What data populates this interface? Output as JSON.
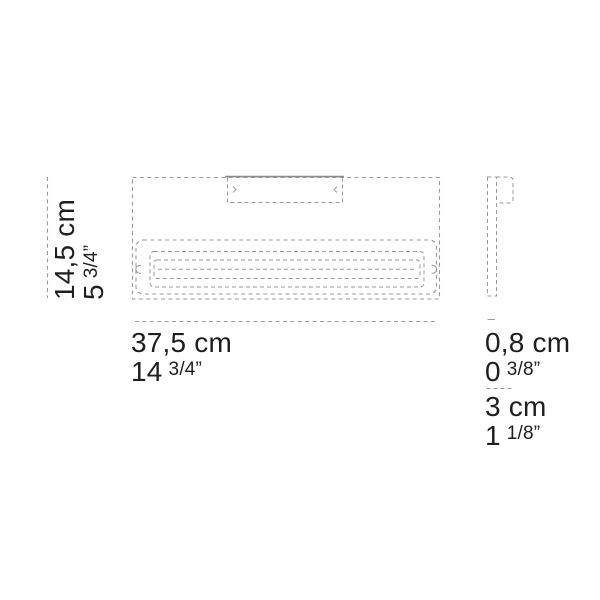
{
  "dimensions": {
    "height": {
      "cm": "14,5 cm",
      "inch_whole": "5",
      "inch_frac": "3/4”"
    },
    "width": {
      "cm": "37,5 cm",
      "inch_whole": "14",
      "inch_frac": "3/4”"
    },
    "depth": {
      "cm": "0,8 cm",
      "inch_whole": "0",
      "inch_frac": "3/8”"
    },
    "mount_depth": {
      "cm": "3 cm",
      "inch_whole": "1",
      "inch_frac": "1/8”"
    }
  },
  "colors": {
    "text": "#1e1e1e",
    "dashed_line": "#9a9a9a",
    "solid_line": "#8c8c8c",
    "background": "#ffffff"
  }
}
